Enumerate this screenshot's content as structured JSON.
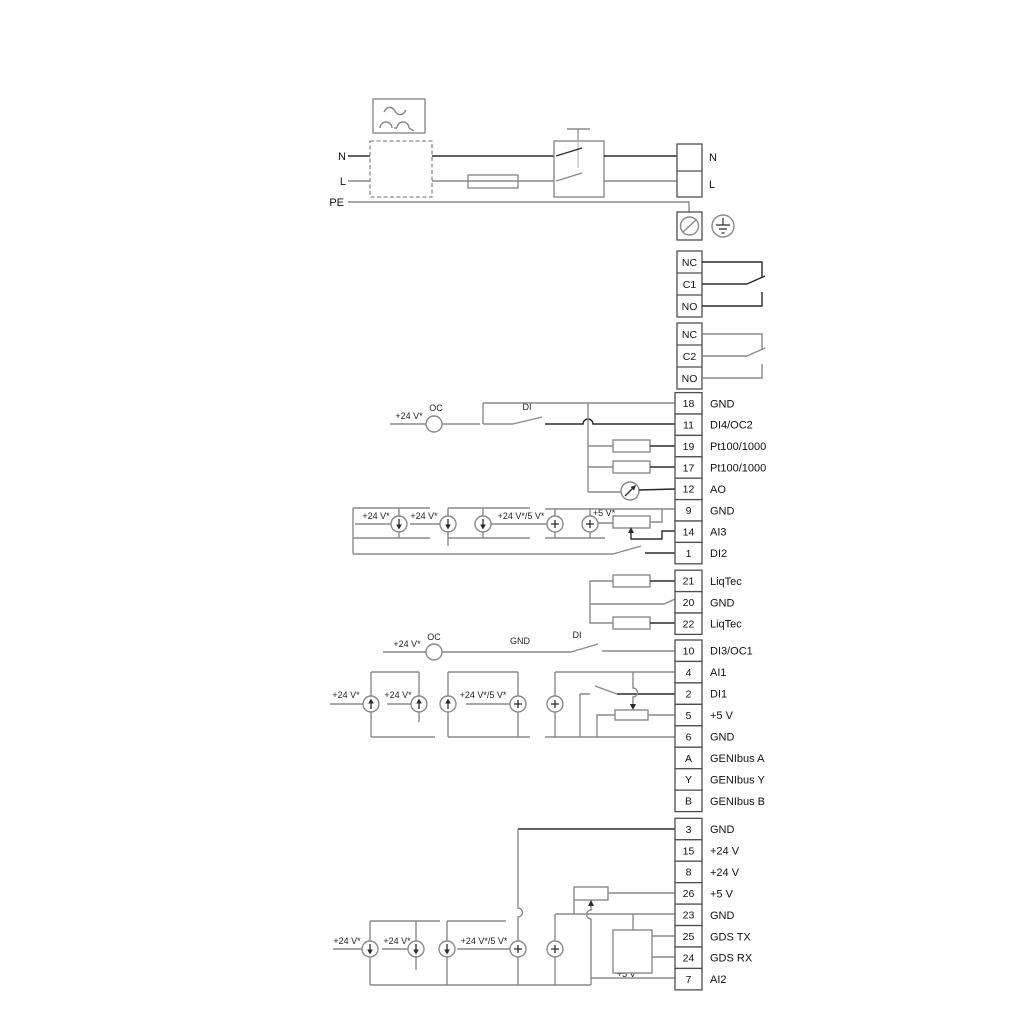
{
  "power": {
    "n_left": "N",
    "l_left": "L",
    "pe": "PE",
    "n_right": "N",
    "l_right": "L"
  },
  "relays": {
    "r1": {
      "nc": "NC",
      "c": "C1",
      "no": "NO"
    },
    "r2": {
      "nc": "NC",
      "c": "C2",
      "no": "NO"
    }
  },
  "strip1": {
    "terminals": [
      [
        "18",
        "GND"
      ],
      [
        "11",
        "DI4/OC2"
      ],
      [
        "19",
        "Pt100/1000"
      ],
      [
        "17",
        "Pt100/1000"
      ],
      [
        "12",
        "AO"
      ],
      [
        "9",
        "GND"
      ],
      [
        "14",
        "AI3"
      ],
      [
        "1",
        "DI2"
      ]
    ]
  },
  "strip2": {
    "terminals": [
      [
        "21",
        "LiqTec"
      ],
      [
        "20",
        "GND"
      ],
      [
        "22",
        "LiqTec"
      ]
    ]
  },
  "strip3": {
    "terminals": [
      [
        "10",
        "DI3/OC1"
      ],
      [
        "4",
        "AI1"
      ],
      [
        "2",
        "DI1"
      ],
      [
        "5",
        "+5 V"
      ],
      [
        "6",
        "GND"
      ],
      [
        "A",
        "GENIbus A"
      ],
      [
        "Y",
        "GENIbus Y"
      ],
      [
        "B",
        "GENIbus B"
      ]
    ]
  },
  "strip4": {
    "terminals": [
      [
        "3",
        "GND"
      ],
      [
        "15",
        "+24 V"
      ],
      [
        "8",
        "+24 V"
      ],
      [
        "26",
        "+5 V"
      ],
      [
        "23",
        "GND"
      ],
      [
        "25",
        "GDS TX"
      ],
      [
        "24",
        "GDS RX"
      ],
      [
        "7",
        "AI2"
      ]
    ]
  },
  "annotations": {
    "v24": "+24 V*",
    "v24_5": "+24 V*/5 V*",
    "v5": "+5 V*",
    "oc": "OC",
    "di": "DI",
    "gnd": "GND"
  },
  "colors": {
    "wire_gray": "#8a8a8a",
    "wire_dark": "#2b2b2b"
  }
}
